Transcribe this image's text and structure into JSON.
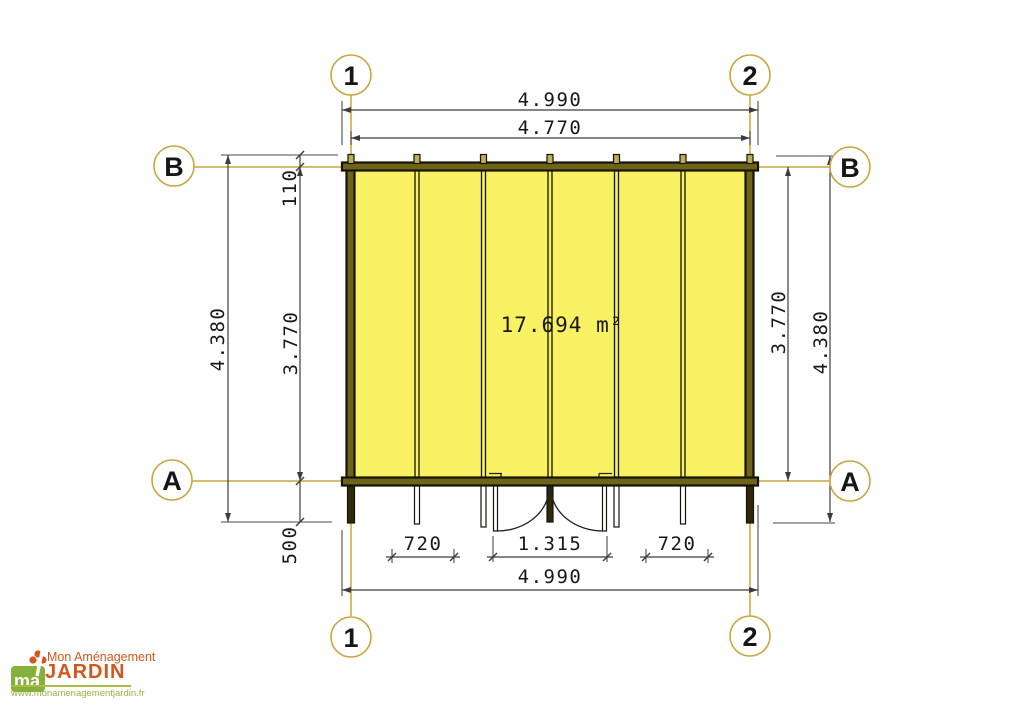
{
  "plan": {
    "area_label": "17.694 m²",
    "grid_bubbles": {
      "col_1": "1",
      "col_2": "2",
      "row_b": "B",
      "row_a": "A"
    },
    "dims": {
      "overall_width": "4.990",
      "inner_width": "4.770",
      "overall_depth": "4.380",
      "inner_depth": "3.770",
      "front_offset": "110",
      "back_offset": "500",
      "side_bay": "720",
      "door_opening": "1.315"
    },
    "colors": {
      "panel_yellow": "#f7f163",
      "beam_olive": "#6e6418",
      "grid_tan": "#c9a63f",
      "dim_gray": "#3c3c3c"
    }
  },
  "logo": {
    "monogram": "ma",
    "brand_top": "Mon Aménagement",
    "brand_main": "JARDIN",
    "url": "www.monamenagementjardin.fr",
    "orange": "#d3571d",
    "green": "#96b43c"
  }
}
